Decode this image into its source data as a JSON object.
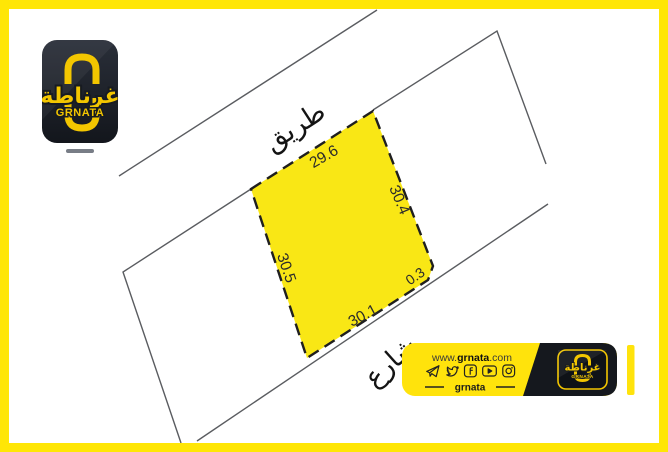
{
  "colors": {
    "frame_yellow": "#FFE606",
    "plot_yellow": "#F9E715",
    "banner_yellow": "#FFE30C",
    "brand_gold": "#F3C600",
    "brand_black": "#171B22",
    "line_gray": "#5A5C60"
  },
  "diagram": {
    "road_label": "طريق",
    "street_label": "شارع",
    "measurements": {
      "top": "29.6",
      "right": "30.4",
      "corner": "0.3",
      "bottom": "30.1",
      "left": "30.5"
    }
  },
  "logo": {
    "arabic": "غرناطة",
    "latin": "GRNATA"
  },
  "banner": {
    "url_www": "www.",
    "url_name": "grnata",
    "url_tld": ".com",
    "handle": "grnata",
    "logo_arabic": "غرناطة",
    "logo_latin": "GRNATA"
  }
}
